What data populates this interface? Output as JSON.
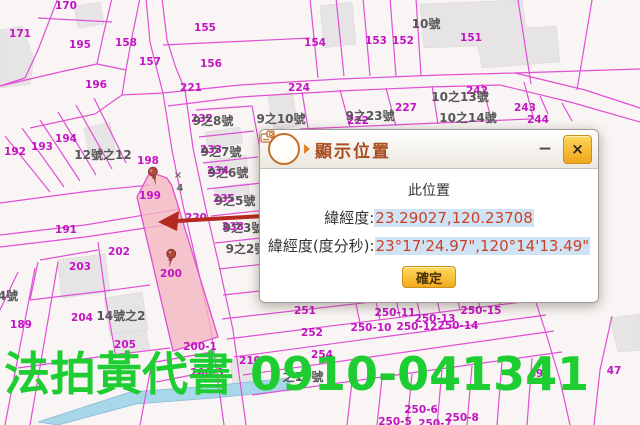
{
  "watermark": {
    "text": "法拍黃代書 0910-041341",
    "color": "#1ecd31"
  },
  "dialog": {
    "title": "顯示位置",
    "minimize": "−",
    "close": "×",
    "heading": "此位置",
    "row1_label": "緯經度:",
    "row1_value": "23.29027,120.23708",
    "row2_label": "緯經度(度分秒):",
    "row2_value": "23°17'24.97\",120°14'13.49\"",
    "confirm": "確定",
    "icon": "show-location-icon"
  },
  "colors": {
    "parcel_line": "#e14fd6",
    "parcel_text": "#c215c2",
    "house_text": "#575757",
    "highlight_fill": "#f4b7c1",
    "arrow_red": "#b5291e",
    "watermark_green": "#1ecd31",
    "coord_text": "#cc4125",
    "coord_highlight_bg": "#cfe3f4",
    "water_blue": "#a9d7ea"
  },
  "map": {
    "labels": [
      {
        "t": "170",
        "x": 66,
        "y": 6,
        "k": "p"
      },
      {
        "t": "171",
        "x": 20,
        "y": 34,
        "k": "p"
      },
      {
        "t": "195",
        "x": 80,
        "y": 45,
        "k": "p"
      },
      {
        "t": "158",
        "x": 126,
        "y": 43,
        "k": "p"
      },
      {
        "t": "157",
        "x": 150,
        "y": 62,
        "k": "p"
      },
      {
        "t": "155",
        "x": 205,
        "y": 28,
        "k": "p"
      },
      {
        "t": "156",
        "x": 211,
        "y": 64,
        "k": "p"
      },
      {
        "t": "154",
        "x": 315,
        "y": 43,
        "k": "p"
      },
      {
        "t": "153",
        "x": 376,
        "y": 41,
        "k": "p"
      },
      {
        "t": "152",
        "x": 403,
        "y": 41,
        "k": "p"
      },
      {
        "t": "151",
        "x": 471,
        "y": 38,
        "k": "p"
      },
      {
        "t": "196",
        "x": 96,
        "y": 85,
        "k": "p"
      },
      {
        "t": "221",
        "x": 191,
        "y": 88,
        "k": "p"
      },
      {
        "t": "224",
        "x": 299,
        "y": 88,
        "k": "p"
      },
      {
        "t": "242",
        "x": 477,
        "y": 91,
        "k": "p"
      },
      {
        "t": "227",
        "x": 406,
        "y": 108,
        "k": "p"
      },
      {
        "t": "222",
        "x": 358,
        "y": 121,
        "k": "p"
      },
      {
        "t": "243",
        "x": 525,
        "y": 108,
        "k": "p"
      },
      {
        "t": "244",
        "x": 538,
        "y": 120,
        "k": "p"
      },
      {
        "t": "232",
        "x": 202,
        "y": 119,
        "k": "p"
      },
      {
        "t": "233",
        "x": 211,
        "y": 150,
        "k": "p"
      },
      {
        "t": "234",
        "x": 218,
        "y": 171,
        "k": "p"
      },
      {
        "t": "235",
        "x": 224,
        "y": 199,
        "k": "p"
      },
      {
        "t": "238",
        "x": 233,
        "y": 227,
        "k": "p"
      },
      {
        "t": "192",
        "x": 15,
        "y": 152,
        "k": "p"
      },
      {
        "t": "193",
        "x": 42,
        "y": 147,
        "k": "p"
      },
      {
        "t": "194",
        "x": 66,
        "y": 139,
        "k": "p"
      },
      {
        "t": "198",
        "x": 148,
        "y": 161,
        "k": "p"
      },
      {
        "t": "199",
        "x": 150,
        "y": 196,
        "k": "p"
      },
      {
        "t": "220",
        "x": 196,
        "y": 218,
        "k": "p"
      },
      {
        "t": "191",
        "x": 66,
        "y": 230,
        "k": "p"
      },
      {
        "t": "202",
        "x": 119,
        "y": 252,
        "k": "p"
      },
      {
        "t": "203",
        "x": 80,
        "y": 267,
        "k": "p"
      },
      {
        "t": "200",
        "x": 171,
        "y": 274,
        "k": "p"
      },
      {
        "t": "204",
        "x": 82,
        "y": 318,
        "k": "p"
      },
      {
        "t": "189",
        "x": 21,
        "y": 325,
        "k": "p"
      },
      {
        "t": "205",
        "x": 125,
        "y": 345,
        "k": "p"
      },
      {
        "t": "200-1",
        "x": 200,
        "y": 347,
        "k": "p"
      },
      {
        "t": "200-3",
        "x": 207,
        "y": 373,
        "k": "p"
      },
      {
        "t": "210",
        "x": 250,
        "y": 361,
        "k": "p"
      },
      {
        "t": "251",
        "x": 305,
        "y": 311,
        "k": "p"
      },
      {
        "t": "252",
        "x": 312,
        "y": 333,
        "k": "p"
      },
      {
        "t": "254",
        "x": 322,
        "y": 355,
        "k": "p"
      },
      {
        "t": "250-10",
        "x": 371,
        "y": 328,
        "k": "p"
      },
      {
        "t": "250-11",
        "x": 395,
        "y": 313,
        "k": "p"
      },
      {
        "t": "250-12",
        "x": 417,
        "y": 327,
        "k": "p"
      },
      {
        "t": "250-13",
        "x": 435,
        "y": 319,
        "k": "p"
      },
      {
        "t": "250-14",
        "x": 458,
        "y": 326,
        "k": "p"
      },
      {
        "t": "250-15",
        "x": 481,
        "y": 311,
        "k": "p"
      },
      {
        "t": "250-5",
        "x": 395,
        "y": 422,
        "k": "p"
      },
      {
        "t": "250-6",
        "x": 421,
        "y": 410,
        "k": "p"
      },
      {
        "t": "250-7",
        "x": 435,
        "y": 424,
        "k": "p"
      },
      {
        "t": "250-8",
        "x": 462,
        "y": 418,
        "k": "p"
      },
      {
        "t": "49",
        "x": 536,
        "y": 374,
        "k": "p"
      },
      {
        "t": "47",
        "x": 614,
        "y": 371,
        "k": "p"
      },
      {
        "t": "10號",
        "x": 426,
        "y": 24,
        "k": "h"
      },
      {
        "t": "12號之12",
        "x": 103,
        "y": 155,
        "k": "h"
      },
      {
        "t": "9之8號",
        "x": 213,
        "y": 121,
        "k": "h"
      },
      {
        "t": "9之7號",
        "x": 221,
        "y": 152,
        "k": "h"
      },
      {
        "t": "9之6號",
        "x": 228,
        "y": 173,
        "k": "h"
      },
      {
        "t": "9之5號",
        "x": 235,
        "y": 201,
        "k": "h"
      },
      {
        "t": "9之3號",
        "x": 243,
        "y": 228,
        "k": "h"
      },
      {
        "t": "9之2號",
        "x": 246,
        "y": 249,
        "k": "h"
      },
      {
        "t": "9之10號",
        "x": 281,
        "y": 119,
        "k": "h"
      },
      {
        "t": "9之23號",
        "x": 370,
        "y": 116,
        "k": "h"
      },
      {
        "t": "10之13號",
        "x": 460,
        "y": 97,
        "k": "h"
      },
      {
        "t": "10之14號",
        "x": 468,
        "y": 118,
        "k": "h"
      },
      {
        "t": "14號之2",
        "x": 121,
        "y": 316,
        "k": "h"
      },
      {
        "t": "4號",
        "x": 8,
        "y": 296,
        "k": "h"
      },
      {
        "t": "之15號",
        "x": 303,
        "y": 377,
        "k": "h"
      },
      {
        "t": "×",
        "x": 178,
        "y": 176,
        "k": "r"
      },
      {
        "t": "4",
        "x": 180,
        "y": 189,
        "k": "r"
      }
    ]
  }
}
